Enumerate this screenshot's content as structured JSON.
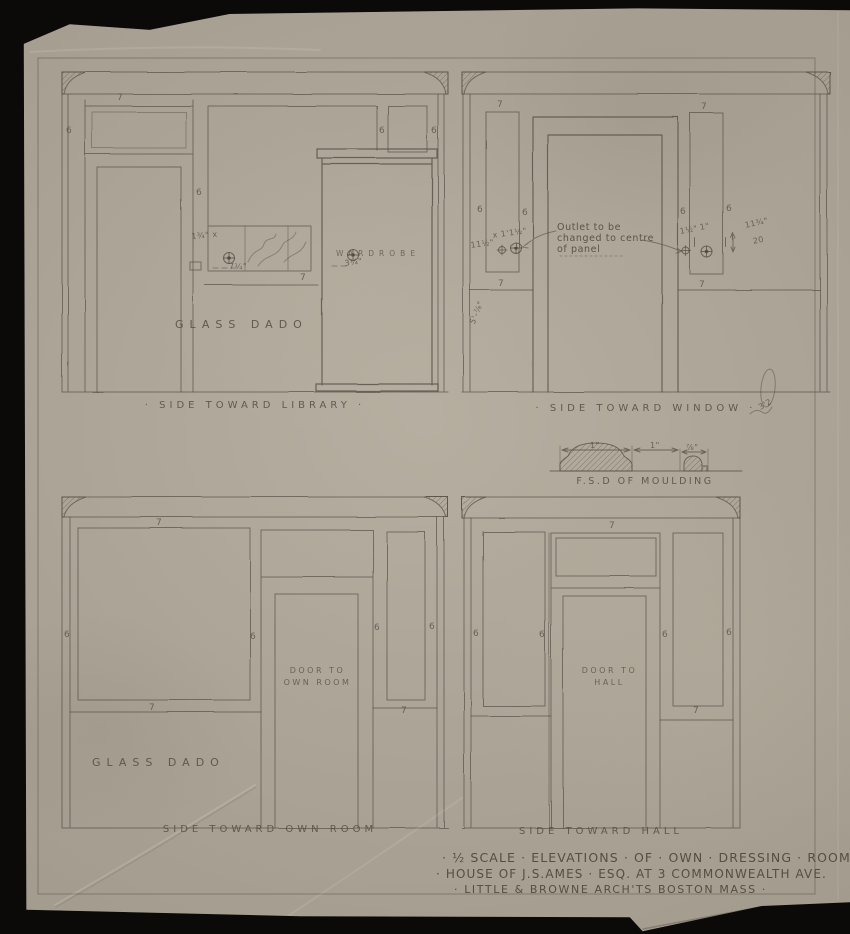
{
  "sheet": {
    "background_color": "#0b0a08",
    "paper_color": "#b2aa9b",
    "pencil_color": "#5a5146"
  },
  "elevations": {
    "library": {
      "caption": "· SIDE TOWARD LIBRARY ·",
      "glass_dado": "GLASS DADO",
      "wardrobe": "WARDROBE"
    },
    "window": {
      "caption": "· SIDE TOWARD WINDOW ·",
      "outlet_note": {
        "line1": "Outlet to be",
        "line2": "changed to centre",
        "line3": "of panel"
      }
    },
    "own_room": {
      "caption": "SIDE TOWARD OWN ROOM",
      "glass_dado": "GLASS DADO",
      "door_label": {
        "line1": "DOOR TO",
        "line2": "OWN ROOM"
      }
    },
    "hall": {
      "caption": "SIDE TOWARD HALL",
      "door_label": {
        "line1": "DOOR TO",
        "line2": "HALL"
      }
    }
  },
  "moulding_detail": {
    "caption": "F.S.D OF MOULDING"
  },
  "title_block": {
    "line1": "· ½ SCALE · ELEVATIONS · OF · OWN · DRESSING · ROOM ·",
    "line2": "· HOUSE OF J.S.AMES · ESQ. AT 3 COMMONWEALTH AVE.",
    "line3": "· LITTLE & BROWNE ARCH'TS BOSTON MASS ·"
  },
  "figure_marks": [
    {
      "t": "7",
      "x": 117,
      "y": 93
    },
    {
      "t": "6",
      "x": 66,
      "y": 126
    },
    {
      "t": "6",
      "x": 196,
      "y": 188
    },
    {
      "t": "6",
      "x": 379,
      "y": 126
    },
    {
      "t": "6",
      "x": 431,
      "y": 126
    },
    {
      "t": "7",
      "x": 300,
      "y": 273
    },
    {
      "t": "1¾\" x",
      "x": 191,
      "y": 232,
      "fs": 8,
      "r": -5
    },
    {
      "t": "7¼\"",
      "x": 229,
      "y": 262,
      "fs": 8
    },
    {
      "t": "3¼\"",
      "x": 344,
      "y": 259,
      "fs": 8,
      "r": -8
    },
    {
      "t": "7",
      "x": 497,
      "y": 100
    },
    {
      "t": "7",
      "x": 701,
      "y": 102
    },
    {
      "t": "6",
      "x": 477,
      "y": 205
    },
    {
      "t": "6",
      "x": 522,
      "y": 208
    },
    {
      "t": "6",
      "x": 680,
      "y": 207
    },
    {
      "t": "6",
      "x": 726,
      "y": 204
    },
    {
      "t": "7",
      "x": 498,
      "y": 279
    },
    {
      "t": "7",
      "x": 699,
      "y": 280
    },
    {
      "t": "11½\"",
      "x": 470,
      "y": 241,
      "fs": 8,
      "r": -8
    },
    {
      "t": "x 1'1½\"",
      "x": 492,
      "y": 231,
      "fs": 8,
      "r": -8
    },
    {
      "t": "1½\"",
      "x": 679,
      "y": 227,
      "fs": 8,
      "r": -10
    },
    {
      "t": "1\"",
      "x": 699,
      "y": 223,
      "fs": 8,
      "r": -10
    },
    {
      "t": "11¾\"",
      "x": 744,
      "y": 221,
      "fs": 8,
      "r": -12
    },
    {
      "t": "20",
      "x": 752,
      "y": 237,
      "fs": 8,
      "r": -12
    },
    {
      "t": "5'-⅞\"",
      "x": 468,
      "y": 322,
      "fs": 8,
      "r": -68
    },
    {
      "t": "1\"",
      "x": 590,
      "y": 441,
      "fs": 8
    },
    {
      "t": "1\"",
      "x": 650,
      "y": 441,
      "fs": 8
    },
    {
      "t": "⅞\"",
      "x": 686,
      "y": 443,
      "fs": 8
    },
    {
      "t": "7",
      "x": 156,
      "y": 518
    },
    {
      "t": "6",
      "x": 64,
      "y": 630
    },
    {
      "t": "6",
      "x": 250,
      "y": 632
    },
    {
      "t": "7",
      "x": 149,
      "y": 703
    },
    {
      "t": "6",
      "x": 374,
      "y": 623
    },
    {
      "t": "6",
      "x": 429,
      "y": 622
    },
    {
      "t": "7",
      "x": 401,
      "y": 706
    },
    {
      "t": "7",
      "x": 609,
      "y": 521
    },
    {
      "t": "6",
      "x": 473,
      "y": 629
    },
    {
      "t": "6",
      "x": 539,
      "y": 630
    },
    {
      "t": "6",
      "x": 662,
      "y": 630
    },
    {
      "t": "6",
      "x": 726,
      "y": 628
    },
    {
      "t": "7",
      "x": 693,
      "y": 706
    },
    {
      "t": "3'2",
      "x": 757,
      "y": 404,
      "fs": 8,
      "r": -30
    }
  ]
}
